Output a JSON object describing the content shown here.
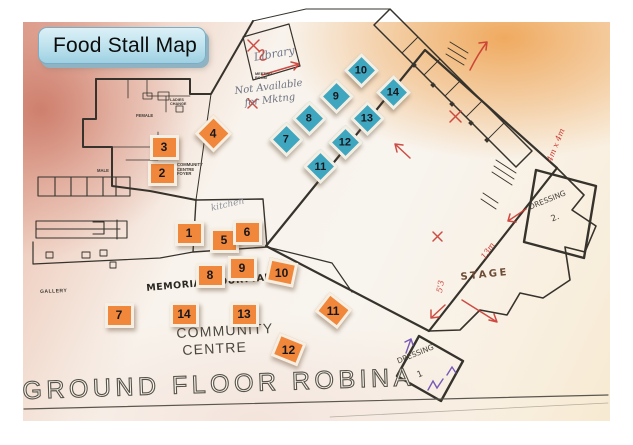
{
  "title": "Food Stall Map",
  "map": {
    "printed_labels": [
      {
        "id": "ground-floor-title",
        "text": "GROUND FLOOR ROBINA",
        "x": 22,
        "y": 377,
        "size": 25,
        "rot": -2,
        "spacing": 4.5,
        "style": "outline"
      },
      {
        "id": "community-label",
        "text": "COMMUNITY",
        "x": 176,
        "y": 326,
        "size": 14,
        "rot": -3,
        "spacing": 1.2,
        "color": "#4a473f"
      },
      {
        "id": "centre-label",
        "text": "CENTRE",
        "x": 182,
        "y": 343,
        "size": 14,
        "rot": -3,
        "spacing": 1.2,
        "color": "#4a473f"
      },
      {
        "id": "gallery-label",
        "text": "GALLERY",
        "x": 40,
        "y": 290,
        "size": 5,
        "rot": -2,
        "spacing": 0.5,
        "color": "#3e3b34",
        "weight": 700
      },
      {
        "id": "community-centre-foyer-label",
        "text": "COMMUNITY\nCENTRE\nFOYER",
        "x": 177,
        "y": 163,
        "size": 4.2,
        "rot": 0,
        "color": "#3e3b34",
        "weight": 700
      },
      {
        "id": "male-label",
        "text": "MALE",
        "x": 97,
        "y": 169,
        "size": 4.2,
        "rot": 0,
        "color": "#3e3b34",
        "weight": 700
      },
      {
        "id": "female-label",
        "text": "FEMALE",
        "x": 136,
        "y": 114,
        "size": 4.2,
        "rot": 0,
        "color": "#3e3b34",
        "weight": 700
      },
      {
        "id": "ladies-label",
        "text": "LADIES\nCHANGE",
        "x": 170,
        "y": 98,
        "size": 3.8,
        "rot": 0,
        "color": "#3e3b34",
        "weight": 700
      },
      {
        "id": "meeting-room-label",
        "text": "MEETING\nROOM",
        "x": 255,
        "y": 72,
        "size": 3.8,
        "rot": 0,
        "color": "#3e3b34",
        "weight": 700
      }
    ],
    "handwritten": [
      {
        "id": "library-note",
        "text": "Library",
        "x": 253,
        "y": 52,
        "size": 11,
        "rot": -10,
        "kind": "script",
        "color": "#70768a"
      },
      {
        "id": "not-available-note-1",
        "text": "Not Available",
        "x": 234,
        "y": 86,
        "size": 10,
        "rot": -7,
        "kind": "script",
        "color": "#6e7280"
      },
      {
        "id": "not-available-note-2",
        "text": "for Mktng",
        "x": 244,
        "y": 98,
        "size": 10,
        "rot": -7,
        "kind": "script",
        "color": "#6e7280"
      },
      {
        "id": "kitchen-note",
        "text": "kitchen",
        "x": 210,
        "y": 204,
        "size": 9,
        "rot": -13,
        "kind": "script",
        "color": "#8f93a0"
      },
      {
        "id": "memorial-courtyard-note",
        "text": "MEMORIAL COURTYARD",
        "x": 146,
        "y": 284,
        "size": 9.5,
        "rot": -5,
        "kind": "caps",
        "weight": 700,
        "spacing": 0.5,
        "color": "#2a2822"
      },
      {
        "id": "stage-note",
        "text": "STAGE",
        "x": 460,
        "y": 272,
        "size": 10,
        "rot": -6,
        "kind": "caps",
        "weight": 600,
        "spacing": 2.5,
        "color": "#6d4c35"
      },
      {
        "id": "dressing2-note",
        "text": "DRESSING",
        "x": 528,
        "y": 204,
        "size": 7.5,
        "rot": -22,
        "kind": "caps",
        "color": "#46413a"
      },
      {
        "id": "dressing2-number",
        "text": "2.",
        "x": 550,
        "y": 216,
        "size": 8.5,
        "rot": -22,
        "kind": "caps",
        "color": "#46413a"
      },
      {
        "id": "dressing1-note",
        "text": "DRESSING",
        "x": 396,
        "y": 358,
        "size": 7.5,
        "rot": -22,
        "kind": "caps",
        "color": "#46413a"
      },
      {
        "id": "dressing1-number",
        "text": "1",
        "x": 416,
        "y": 372,
        "size": 8.5,
        "rot": -22,
        "kind": "caps",
        "color": "#46413a"
      },
      {
        "id": "dimension-4m-x-4m",
        "text": "4m x 4m",
        "x": 546,
        "y": 160,
        "size": 8,
        "rot": -68,
        "kind": "script",
        "color": "#c93a32"
      },
      {
        "id": "dimension-13m",
        "text": "13m",
        "x": 480,
        "y": 256,
        "size": 8,
        "rot": -55,
        "kind": "script",
        "color": "#c93a32"
      },
      {
        "id": "dimension-5-3",
        "text": "5'3",
        "x": 436,
        "y": 292,
        "size": 8,
        "rot": -80,
        "kind": "script",
        "color": "#c93a32"
      }
    ],
    "markers": {
      "orange": {
        "color": "#F0873B",
        "w": 23,
        "h": 19,
        "items": [
          {
            "n": "1",
            "x": 189,
            "y": 233
          },
          {
            "n": "2",
            "x": 162,
            "y": 173
          },
          {
            "n": "3",
            "x": 164,
            "y": 147
          },
          {
            "n": "4",
            "x": 213,
            "y": 133,
            "rot": 45,
            "w": 21,
            "h": 21
          },
          {
            "n": "5",
            "x": 224,
            "y": 240
          },
          {
            "n": "6",
            "x": 247,
            "y": 232
          },
          {
            "n": "7",
            "x": 119,
            "y": 315
          },
          {
            "n": "8",
            "x": 210,
            "y": 275
          },
          {
            "n": "9",
            "x": 242,
            "y": 268
          },
          {
            "n": "10",
            "x": 281,
            "y": 272,
            "rot": 12
          },
          {
            "n": "11",
            "x": 333,
            "y": 310,
            "rot": 38
          },
          {
            "n": "12",
            "x": 288,
            "y": 349,
            "rot": 22
          },
          {
            "n": "13",
            "x": 244,
            "y": 314
          },
          {
            "n": "14",
            "x": 184,
            "y": 314
          }
        ]
      },
      "blue": {
        "color": "#3FA6C0",
        "w": 19,
        "h": 19,
        "items": [
          {
            "n": "7",
            "x": 286,
            "y": 139,
            "rot": 45
          },
          {
            "n": "8",
            "x": 309,
            "y": 118,
            "rot": 45
          },
          {
            "n": "9",
            "x": 336,
            "y": 96,
            "rot": 45
          },
          {
            "n": "10",
            "x": 361,
            "y": 70,
            "rot": 45
          },
          {
            "n": "11",
            "x": 320,
            "y": 166,
            "rot": 45
          },
          {
            "n": "12",
            "x": 345,
            "y": 142,
            "rot": 45
          },
          {
            "n": "13",
            "x": 367,
            "y": 118,
            "rot": 45
          },
          {
            "n": "14",
            "x": 393,
            "y": 92,
            "rot": 45
          }
        ]
      }
    }
  },
  "colors": {
    "accent_orange": "#F0873B",
    "accent_blue": "#3FA6C0",
    "badge_blue": "#BCE1ED",
    "annotation_red": "#C93A32",
    "annotation_purple": "#6A48B0",
    "wall_ink": "#36332C"
  }
}
